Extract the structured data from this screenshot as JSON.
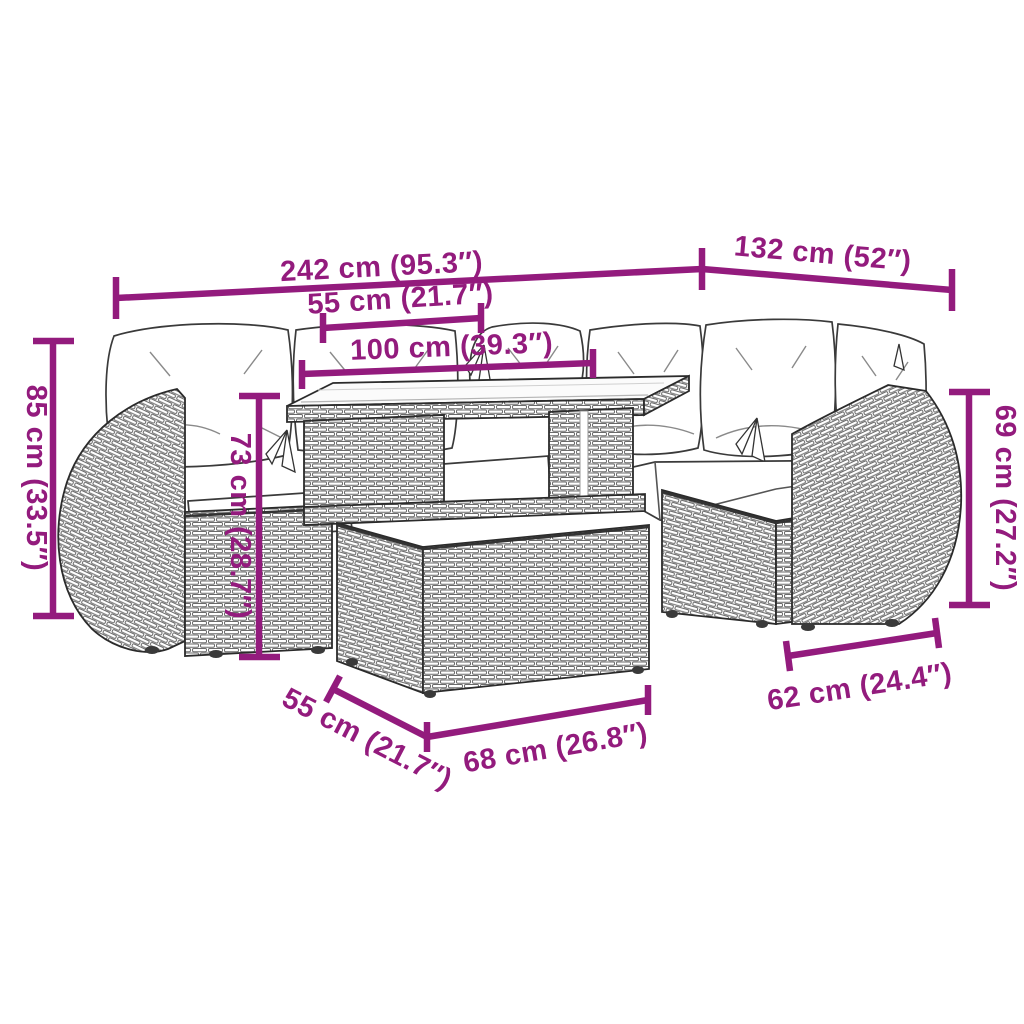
{
  "colors": {
    "dimension_accent": "#931B7D",
    "line_art_outline": "#2B2B2B",
    "weave_stroke": "#6B6B6B",
    "cushion_fill": "#FFFFFF",
    "background": "#FFFFFF"
  },
  "dimensions": [
    {
      "id": "overall-width",
      "text": "242 cm (95.3″)"
    },
    {
      "id": "right-section-width",
      "text": "132 cm (52″)"
    },
    {
      "id": "tabletop-top-depth",
      "text": "55 cm (21.7″)"
    },
    {
      "id": "tabletop-width",
      "text": "100 cm (39.3″)"
    },
    {
      "id": "overall-height",
      "text": "85 cm (33.5″)"
    },
    {
      "id": "table-height",
      "text": "73 cm (28.7″)"
    },
    {
      "id": "backrest-height",
      "text": "69 cm (27.2″)"
    },
    {
      "id": "seat-section-width",
      "text": "62 cm (24.4″)"
    },
    {
      "id": "table-base-depth",
      "text": "55 cm (21.7″)"
    },
    {
      "id": "table-base-width",
      "text": "68 cm (26.8″)"
    }
  ]
}
